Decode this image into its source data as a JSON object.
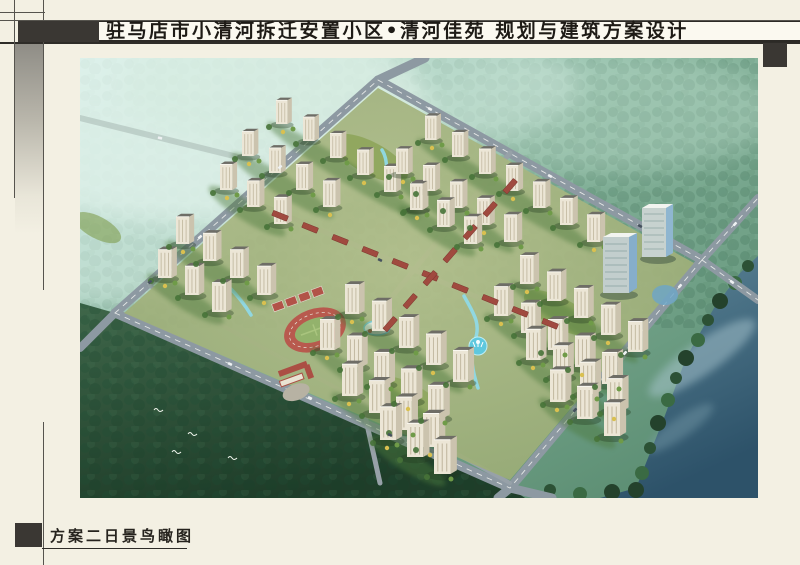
{
  "title_bar": {
    "text": "驻马店市小清河拆迁安置小区•清河佳苑 规划与建筑方案设计"
  },
  "caption": {
    "text": "方案二日景鸟瞰图"
  },
  "palette": {
    "paper": "#f3f0e3",
    "title_box_fill": "#fbf9f0",
    "ink_accent": "#3a3733",
    "rule_line": "#56544e",
    "title_ink": "#1e1b16",
    "mist_teal": "#bfe5da",
    "forest_dark": "#27482f",
    "lake_blue": "#3d6b82",
    "road_gray": "#8d99a2",
    "building_cream": "#ece6d6",
    "roof_dark": "#6e6d66",
    "commercial_red": "#a04a3f",
    "track_red": "#b85a4e",
    "water_cyan": "#8fd9e6",
    "tower_glass_blue": "#8fb6d0",
    "tree_yellow": "#d9c050"
  }
}
